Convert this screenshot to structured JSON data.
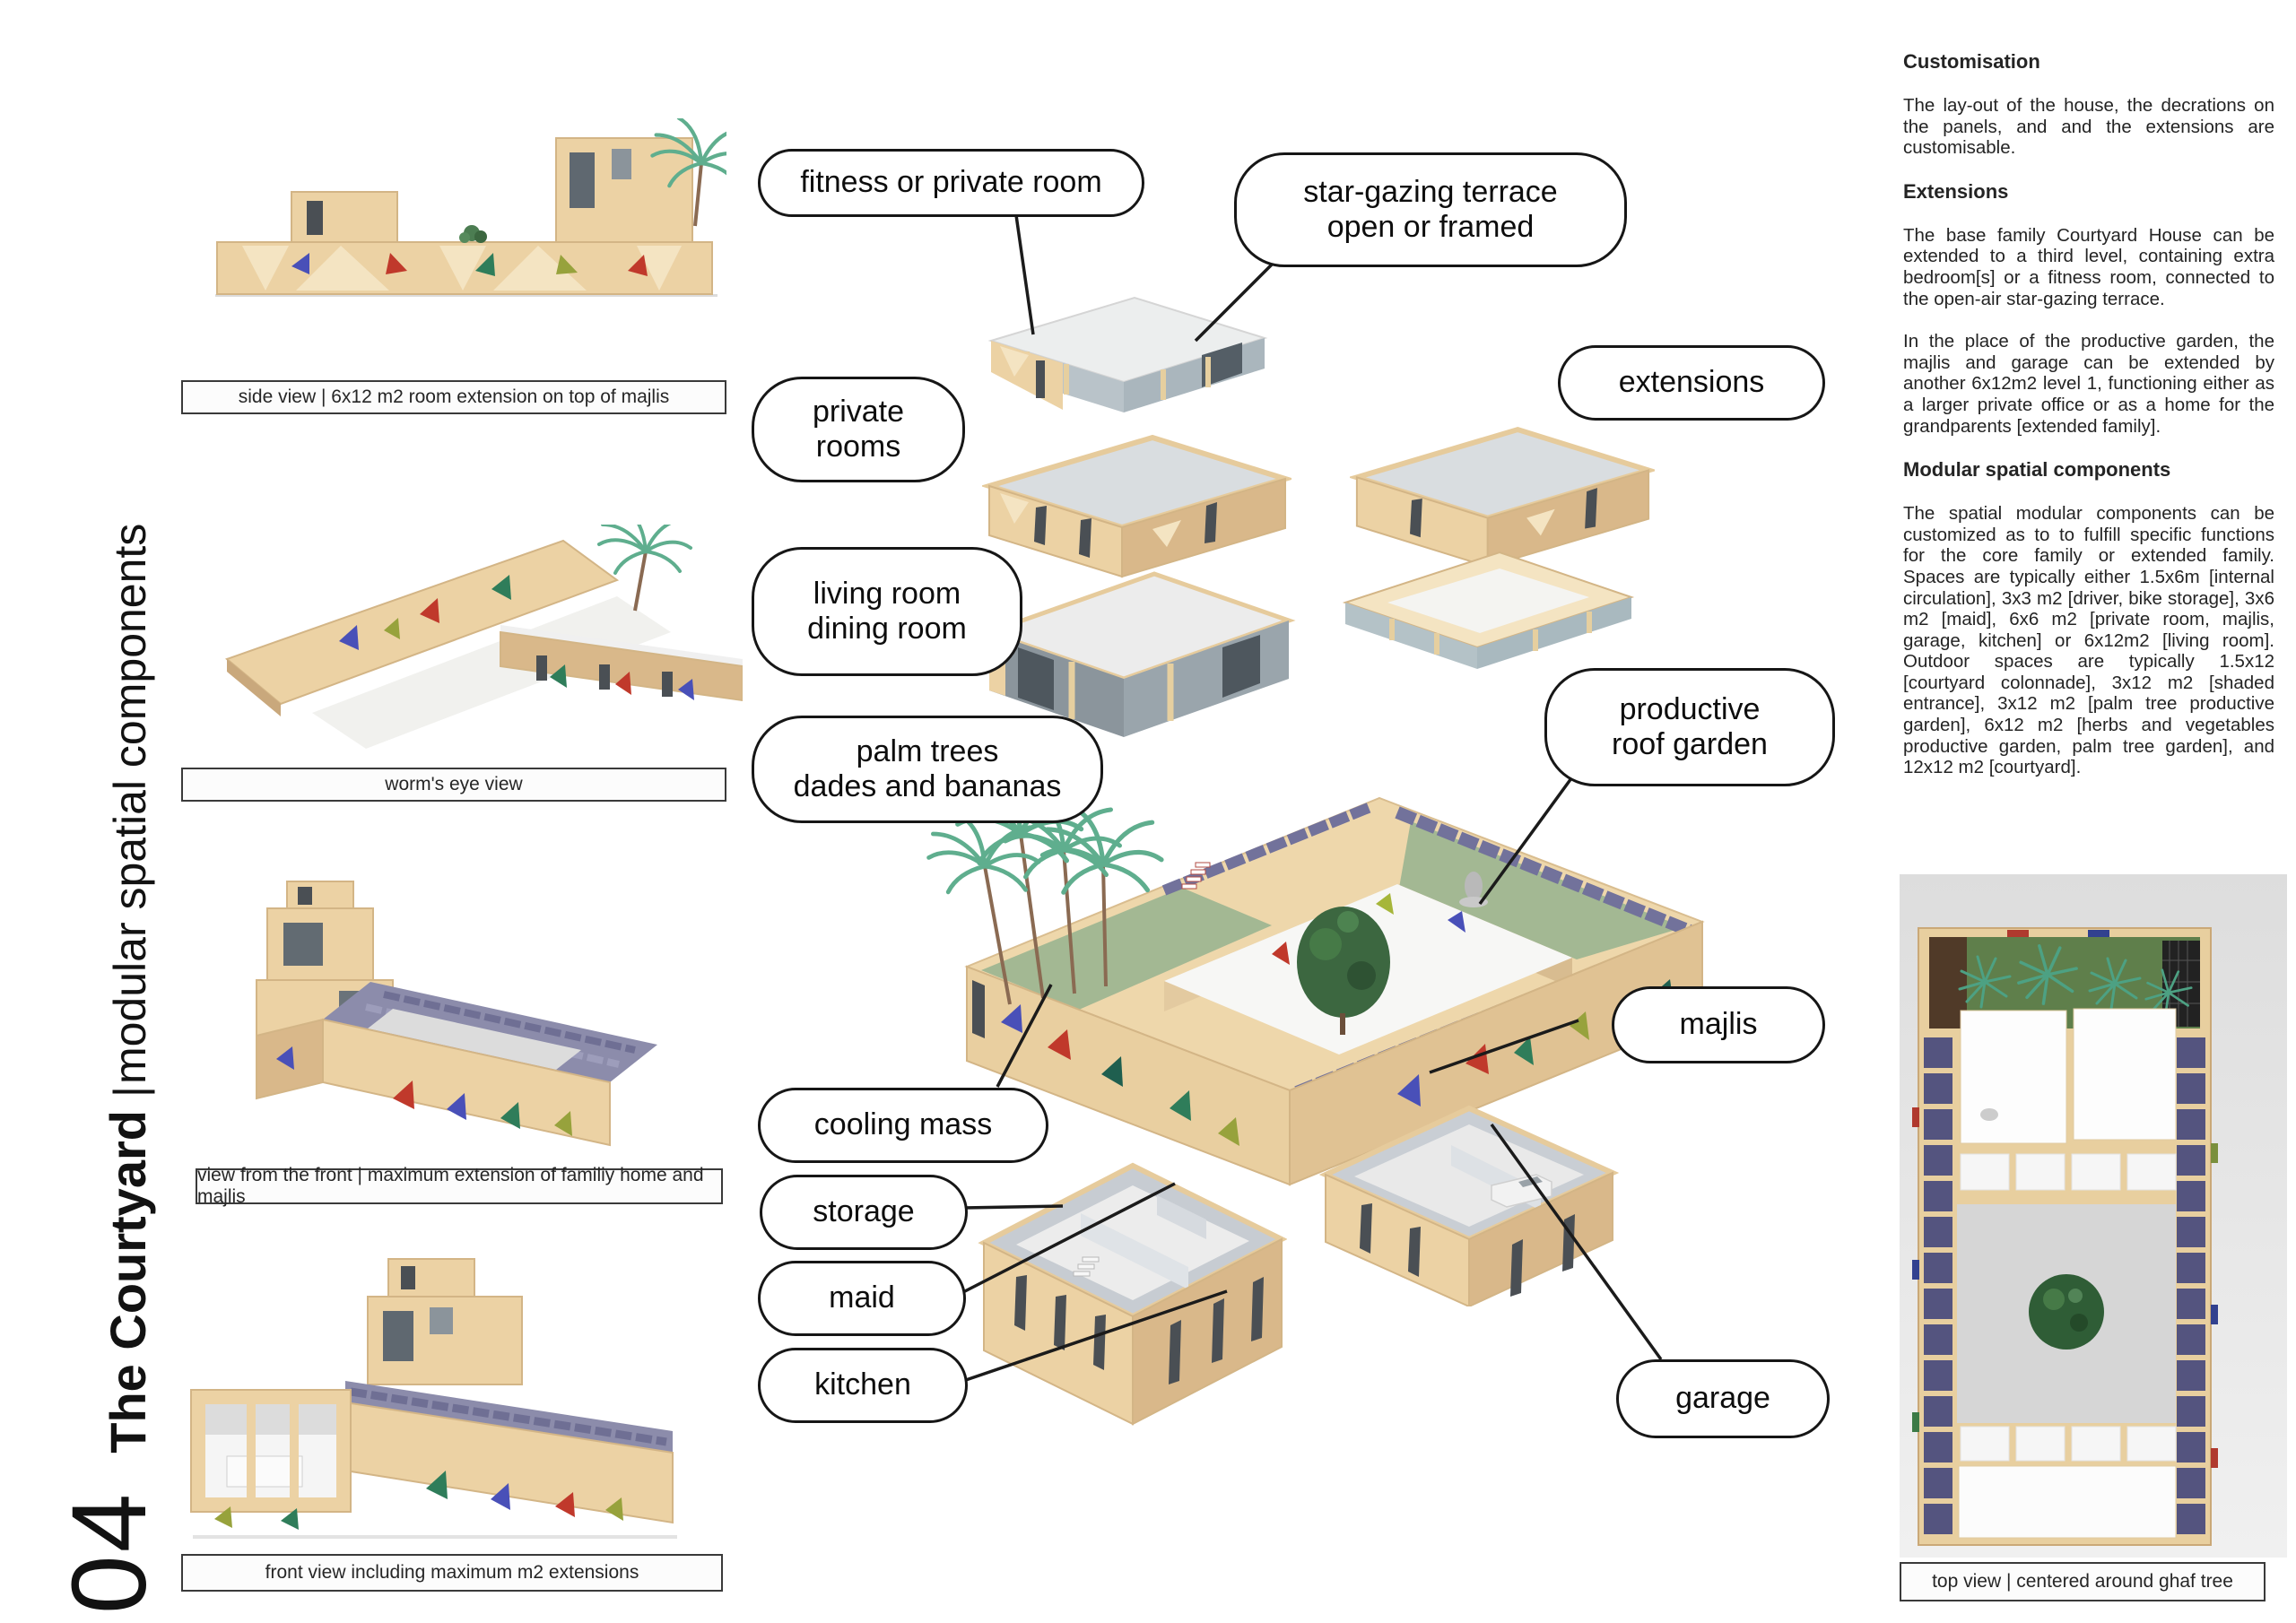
{
  "poster": {
    "vertical_title": {
      "number": "04",
      "name": "The Courtyard",
      "separator": "|",
      "subtitle": "modular spatial components"
    }
  },
  "left_views": [
    {
      "caption": "side view | 6x12 m2 room extension on top of majlis"
    },
    {
      "caption": "worm's eye view"
    },
    {
      "caption": "view from the front | maximum extension of familiy home and majlis"
    },
    {
      "caption": "front view including maximum m2 extensions"
    }
  ],
  "callouts": {
    "fitness": "fitness or private room",
    "star_gazing": "star-gazing terrace\nopen or framed",
    "private_rooms": "private\nrooms",
    "extensions": "extensions",
    "living": "living room\ndining room",
    "palm_trees": "palm trees\ndades and bananas",
    "roof_garden": "productive\nroof garden",
    "cooling_mass": "cooling mass",
    "storage": "storage",
    "maid": "maid",
    "kitchen": "kitchen",
    "majlis": "majlis",
    "garage": "garage"
  },
  "right_panel": {
    "sections": [
      {
        "heading": "Customisation",
        "paragraphs": [
          "The lay-out of the house, the decrations on the panels, and and the extensions are customisable."
        ]
      },
      {
        "heading": "Extensions",
        "paragraphs": [
          "The base family Courtyard House can be extended to a third level, containing extra bedroom[s] or a fitness room, connected to the open-air star-gazing terrace.",
          "In the place of the productive garden, the majlis and garage can be extended by another 6x12m2 level 1, functioning either as a larger private office or as a home for the grandparents [extended family]."
        ]
      },
      {
        "heading": "Modular spatial components",
        "paragraphs": [
          "The spatial modular components can be customized as to to fulfill specific functions for the core family or extended family. Spaces are typically either 1.5x6m [internal circulation], 3x3 m2 [driver, bike storage], 3x6 m2 [maid], 6x6 m2 [private room, majlis, garage, kitchen] or 6x12m2 [living room]. Outdoor spaces are typically 1.5x12 [courtyard colonnade], 3x12 m2 [shaded entrance], 3x12 m2 [palm tree productive garden], 6x12 m2 [herbs and vegetables productive garden, palm tree garden], and 12x12 m2 [courtyard]."
        ]
      }
    ]
  },
  "top_view": {
    "caption": "top view | centered around ghaf tree"
  },
  "colors": {
    "sand": "#ecd2a4",
    "sand_dark": "#d9b88a",
    "roof_green": "#a3b893",
    "solar_panel": "#72729b",
    "palm_green": "#5fae8e",
    "tree_green": "#3c6740",
    "accent_red": "#c0392b",
    "accent_blue": "#4950b8",
    "accent_green": "#2f7d5a",
    "accent_olive": "#97a23c"
  }
}
